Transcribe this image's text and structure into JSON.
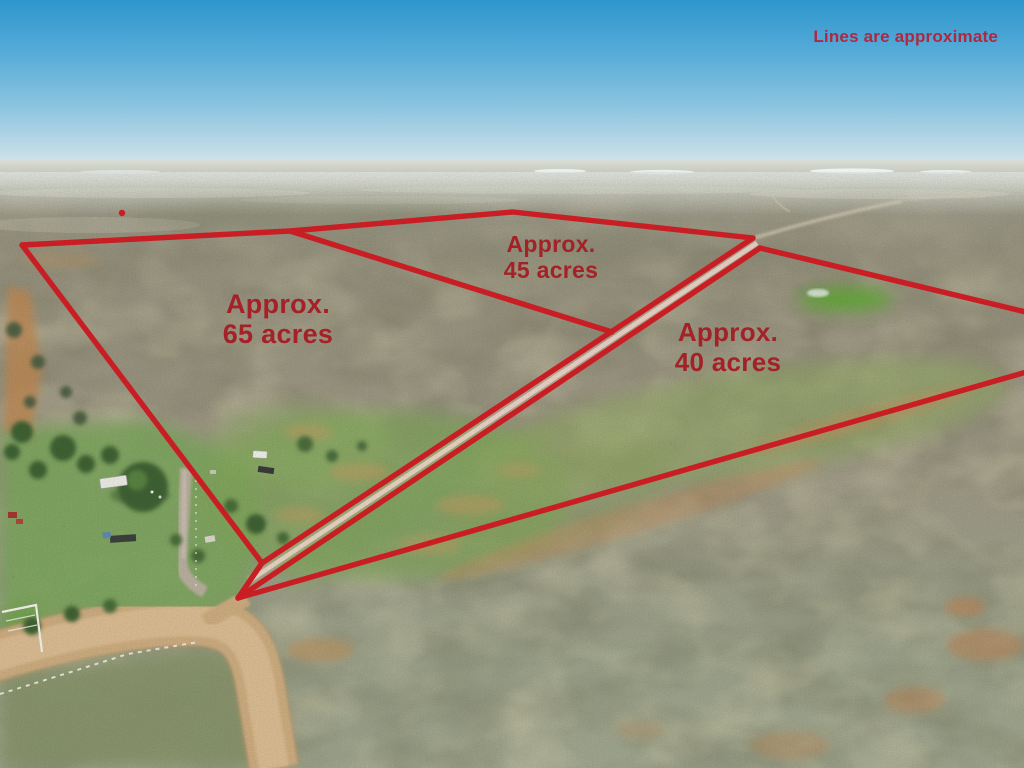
{
  "photo": {
    "description": "Aerial drone photo of Texas ranch scrubland with a homestead, dirt road, and red property boundary overlay",
    "colors": {
      "line_color": "#cf1e25",
      "label_color": "#a32127",
      "disclaimer_color": "#b02840",
      "sky_top": "#2e96cd",
      "sky_horizon": "#dce8eb",
      "terrain_base": "#98937f",
      "pasture_green": "#7fa45a",
      "dirt_road_tan": "#cbaa7e"
    }
  },
  "overlay": {
    "disclaimer": "Lines are approximate",
    "parcels": [
      {
        "name": "west-parcel",
        "line1": "Approx.",
        "line2": "65 acres"
      },
      {
        "name": "north-parcel",
        "line1": "Approx.",
        "line2": "45 acres"
      },
      {
        "name": "east-parcel",
        "line1": "Approx.",
        "line2": "40 acres"
      }
    ]
  }
}
